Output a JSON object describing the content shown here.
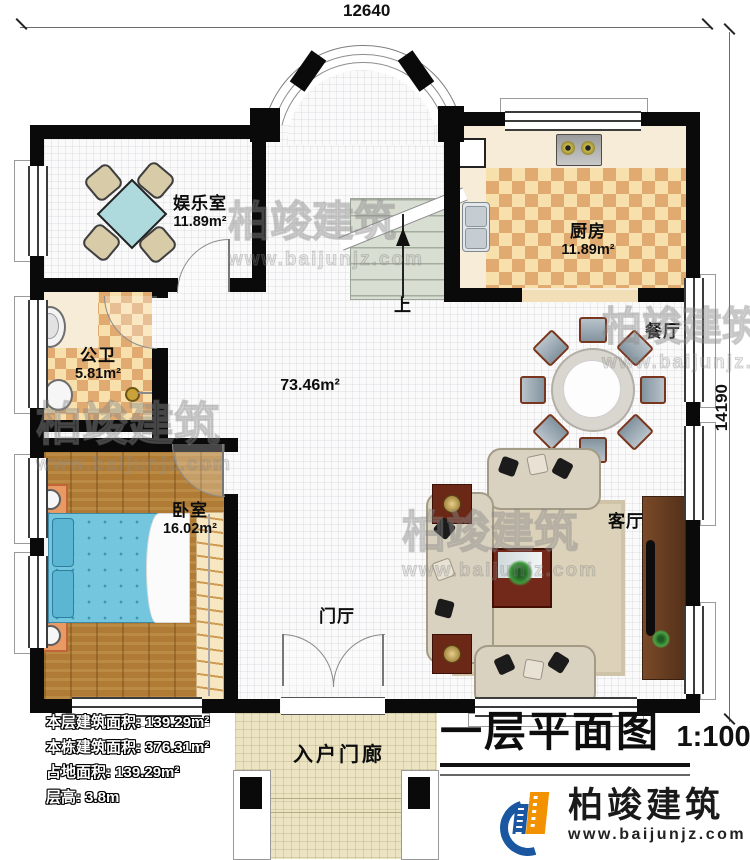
{
  "title": {
    "text": "一层平面图",
    "scale": "1:100"
  },
  "dims": {
    "top": "12640",
    "right": "14190"
  },
  "stair": {
    "label": "上"
  },
  "hall": {
    "area": "73.46m²"
  },
  "rooms": {
    "entertainment": {
      "name": "娱乐室",
      "area": "11.89m²"
    },
    "kitchen": {
      "name": "厨房",
      "area": "11.89m²"
    },
    "dining": {
      "name": "餐厅"
    },
    "bathroom": {
      "name": "公卫",
      "area": "5.81m²"
    },
    "bedroom": {
      "name": "卧室",
      "area": "16.02m²"
    },
    "living": {
      "name": "客厅"
    },
    "foyer": {
      "name": "门厅"
    },
    "porch": {
      "name": "入户门廊"
    }
  },
  "stats": [
    {
      "label": "本层建筑面积:",
      "value": "139.29m²"
    },
    {
      "label": "本栋建筑面积:",
      "value": "376.31m²"
    },
    {
      "label": "占地面积:",
      "value": "139.29m²"
    },
    {
      "label": "层高:",
      "value": "3.8m"
    }
  ],
  "brand": {
    "name": "柏竣建筑",
    "website": "www.baijunjz.com"
  },
  "watermark": {
    "name": "柏竣建筑",
    "website": "www.baijunjz.com"
  },
  "furniture": {
    "entertainment": "square-table-with-4-chairs",
    "kitchen": [
      "gas-stove",
      "double-sink"
    ],
    "bathroom": [
      "washbasin",
      "toilet",
      "towel-bar"
    ],
    "bedroom": [
      "double-bed",
      "nightstand-lamp",
      "nightstand-lamp",
      "wardrobe-hangers"
    ],
    "dining": "round-table-with-8-chairs",
    "living": [
      "sofa-set",
      "rug",
      "coffee-table-with-plant",
      "side-table",
      "side-table",
      "tv-cabinet"
    ],
    "stairs": "staircase-up-arrow",
    "porch": [
      "column",
      "column",
      "steps"
    ]
  },
  "colors": {
    "wall": "#0a0a0a",
    "checker_light": "#f7e0ac",
    "checker_dark": "#e0aa70",
    "wood_floor": "#b07c35",
    "bed_blue": "#74c6de",
    "brand_blue": "#1a57a0",
    "brand_orange": "#f39200"
  }
}
